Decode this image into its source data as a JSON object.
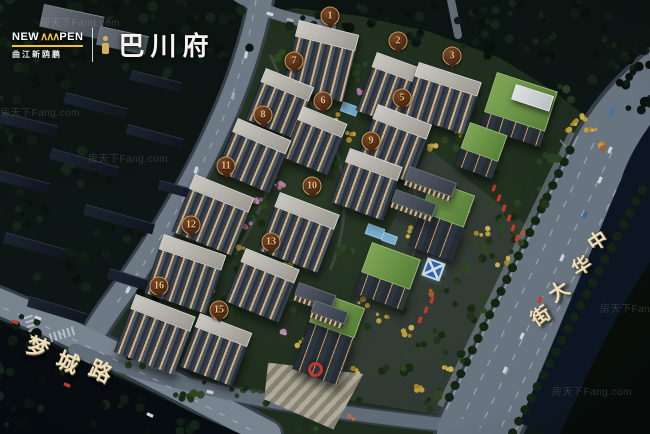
{
  "logo": {
    "brand_left": "NEW",
    "brand_mark": "∧∧∧",
    "brand_right": "PEN",
    "subtitle": "曲江新鸥鹏",
    "project_name": "巴川府"
  },
  "building_markers": [
    {
      "n": "1",
      "x": 330,
      "y": 16
    },
    {
      "n": "2",
      "x": 398,
      "y": 41
    },
    {
      "n": "3",
      "x": 452,
      "y": 56
    },
    {
      "n": "5",
      "x": 402,
      "y": 98
    },
    {
      "n": "6",
      "x": 323,
      "y": 101
    },
    {
      "n": "7",
      "x": 294,
      "y": 61
    },
    {
      "n": "8",
      "x": 263,
      "y": 115
    },
    {
      "n": "9",
      "x": 371,
      "y": 141
    },
    {
      "n": "10",
      "x": 312,
      "y": 186
    },
    {
      "n": "11",
      "x": 226,
      "y": 166
    },
    {
      "n": "12",
      "x": 191,
      "y": 225
    },
    {
      "n": "13",
      "x": 271,
      "y": 242
    },
    {
      "n": "15",
      "x": 219,
      "y": 310
    },
    {
      "n": "16",
      "x": 159,
      "y": 286
    }
  ],
  "street_labels": [
    {
      "name": "mengcheng-road",
      "text": "梦城路",
      "chars": [
        {
          "c": "梦",
          "x": 38,
          "y": 346,
          "r": 20,
          "s": 22
        },
        {
          "c": "城",
          "x": 68,
          "y": 361,
          "r": 23,
          "s": 22
        },
        {
          "c": "路",
          "x": 101,
          "y": 370,
          "r": 24,
          "s": 22
        }
      ]
    },
    {
      "name": "zhonghua-street",
      "text": "中华大街",
      "chars": [
        {
          "c": "中",
          "x": 597,
          "y": 240,
          "r": -33,
          "s": 19
        },
        {
          "c": "华",
          "x": 581,
          "y": 265,
          "r": -33,
          "s": 19
        },
        {
          "c": "大",
          "x": 558,
          "y": 290,
          "r": -33,
          "s": 20
        },
        {
          "c": "街",
          "x": 540,
          "y": 315,
          "r": -33,
          "s": 19
        }
      ]
    }
  ],
  "watermark": {
    "text": "房天下Fang.com",
    "spots": [
      [
        40,
        14
      ],
      [
        0,
        104
      ],
      [
        88,
        150
      ],
      [
        600,
        300
      ],
      [
        552,
        383
      ]
    ]
  }
}
